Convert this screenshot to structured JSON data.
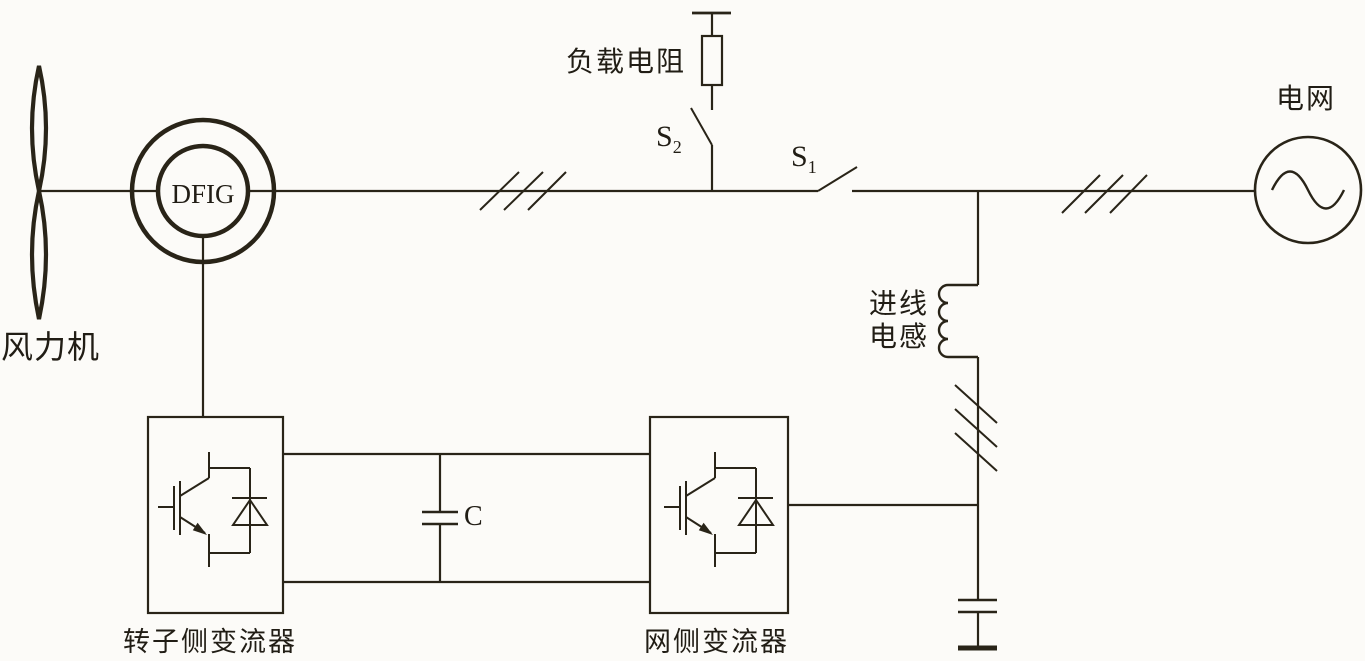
{
  "labels": {
    "wind_turbine": "风力机",
    "generator": "DFIG",
    "load_resistor": "负载电阻",
    "switch_s2_base": "S",
    "switch_s2_sub": "2",
    "switch_s1_base": "S",
    "switch_s1_sub": "1",
    "grid": "电网",
    "line_inductor_line1": "进线",
    "line_inductor_line2": "电感",
    "dc_capacitor": "C",
    "rotor_side_converter": "转子侧变流器",
    "grid_side_converter": "网侧变流器"
  },
  "colors": {
    "line": "#292418",
    "background": "#fcfbf8",
    "text": "#211d15"
  }
}
